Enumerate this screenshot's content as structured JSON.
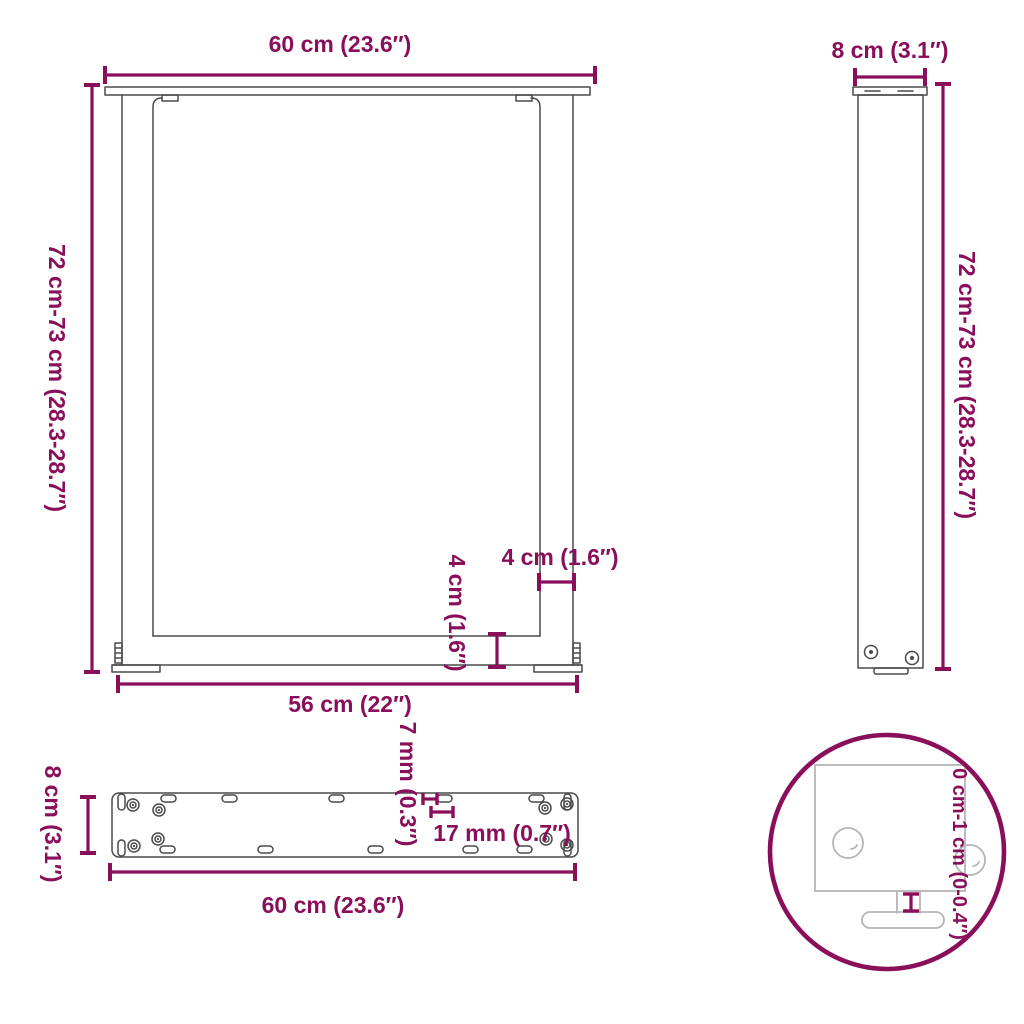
{
  "front_view": {
    "top_width": "60 cm (23.6″)",
    "height": "72 cm-73 cm (28.3-28.7″)",
    "leg_thickness": "4 cm (1.6″)",
    "crossbar_thickness": "4 cm (1.6″)",
    "inner_width": "56 cm (22″)"
  },
  "side_view": {
    "depth": "8 cm (3.1″)",
    "height": "72 cm-73 cm (28.3-28.7″)"
  },
  "plate_view": {
    "length": "60 cm (23.6″)",
    "width": "8 cm (3.1″)",
    "slot_width": "7 mm (0.3″)",
    "slot_length": "17 mm (0.7″)"
  },
  "detail_view": {
    "height_adjustment": "0 cm-1 cm (0-0.4″)"
  },
  "colors": {
    "dimension": "#8a0f5b",
    "drawing": "#4a4a4a",
    "light_drawing": "#b5b5b5",
    "background": "#ffffff"
  }
}
